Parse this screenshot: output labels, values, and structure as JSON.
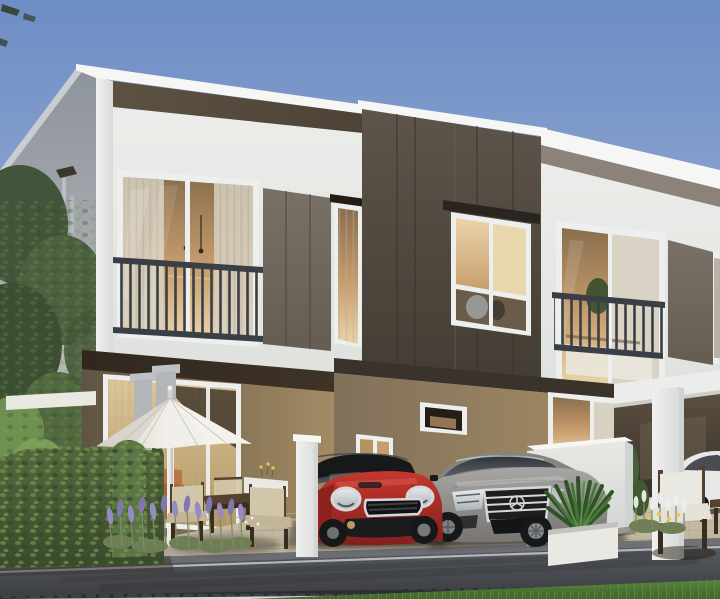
{
  "scene": {
    "title": "3D exterior rendering of modern two-storey townhomes at dusk with parked cars, patio umbrella and landscaped street",
    "type": "architectural-visualization",
    "objects": [
      "white two-storey townhouse row",
      "dark taupe feature panel",
      "juliet balcony windows",
      "recessed patio with sliding glass door",
      "white market umbrella",
      "wooden outdoor dining set",
      "red mini cooper hatchback",
      "silver mercedes sedan",
      "white car in carport",
      "white privacy wall",
      "agave planter",
      "trimmed hedge",
      "lavender bed",
      "paver driveway",
      "asphalt street",
      "grass verge",
      "background tree"
    ]
  },
  "palette": {
    "sky_top": "#6d8dc6",
    "sky_mid": "#96abd0",
    "sky_low": "#c6cedd",
    "sky_horizon": "#dad8dc",
    "white_bright": "#f6f7f5",
    "white_facade": "#ecedea",
    "white_facade_low": "#dfe1de",
    "white_shade": "#cfd3d2",
    "grey_wall_top": "#8e949b",
    "grey_wall_bottom": "#c3c5c7",
    "concrete": "#bfc2c4",
    "concrete_dark": "#b3b6b8",
    "soffit_light": "#5d5142",
    "soffit_dark": "#4c4235",
    "box_top": "#5d554b",
    "box_bottom": "#443d34",
    "panel_light": "#797165",
    "panel_dark": "#655d52",
    "taupe_soffit": "#8b8279",
    "header_dark": "#2a2520",
    "tan_dark": "#5f5443",
    "tan_mid": "#81705a",
    "tan_light": "#a38b64",
    "band_dark": "#3a332b",
    "glass_warm_dark": "#8a6e4e",
    "glass_warm": "#c79d6c",
    "glass_warm_light": "#e9d5aa",
    "glass_cool": "#d8d1c2",
    "glass_dark": "#2d3137",
    "glass_dark2": "#596068",
    "curtain_light": "#dcc697",
    "curtain_dark": "#b3945f",
    "interior_dark": "#241d16",
    "lower_glass": "#6b5c49",
    "railing": "#3a3f45",
    "frame_white": "#edefee",
    "slat": "#b7ae9e",
    "hedge_dark": "#3a4a2c",
    "hedge_mid": "#54683d",
    "hedge_light": "#7d9c52",
    "bush_green": "#5b7544",
    "tree_dark": "#42553a",
    "tree_mid": "#4c6140",
    "tree_light": "#6f9150",
    "grass_dark": "#3f662c",
    "grass_light": "#55823c",
    "lavender": "#948cc0",
    "lavender_deep": "#7f77ad",
    "stem_green": "#7e8a68",
    "foliage_base": "#6e7f55",
    "umbrella_light": "#f1efe9",
    "umbrella_shade": "#d4d0c7",
    "wood_dark": "#3a2d1f",
    "wood_mid": "#53422e",
    "cushion": "#d2c6aa",
    "cushion_dark": "#c3b698",
    "cushion_white": "#e3e1d8",
    "paver_light": "#cdc3ab",
    "paver_dark": "#b5aa92",
    "paver_joint": "#a89d83",
    "gravel": "#6f685c",
    "gravel_patch": "#b6ae9c",
    "road_light": "#5d5f66",
    "road_dark": "#3c3e44",
    "road_line": "#c6c8c7",
    "road_edge": "#83858b",
    "gutter_dark": "#2c2f34",
    "mini_red": "#c5372f",
    "mini_red_deep": "#82201c",
    "car_black": "#17181a",
    "chrome": "#d5d7d8",
    "lamp_light": "#e8ebed",
    "lamp_dark": "#aab1b7",
    "merc_light": "#a7a6a3",
    "merc_dark": "#767572",
    "white_car": "#e7e8e8",
    "planter_white": "#e9e8e3",
    "orange_sofa": "#a96336",
    "orange_sofa_light": "#bb7547",
    "pillar_light": "#f0f1ef",
    "pillar_shade": "#d9dbd9",
    "carport_light": "#5a4f40",
    "carport_dark": "#27221c",
    "carport_mid": "#6b5f4c",
    "bed_white": "#eae7dc",
    "sliver": "#a9a396"
  }
}
